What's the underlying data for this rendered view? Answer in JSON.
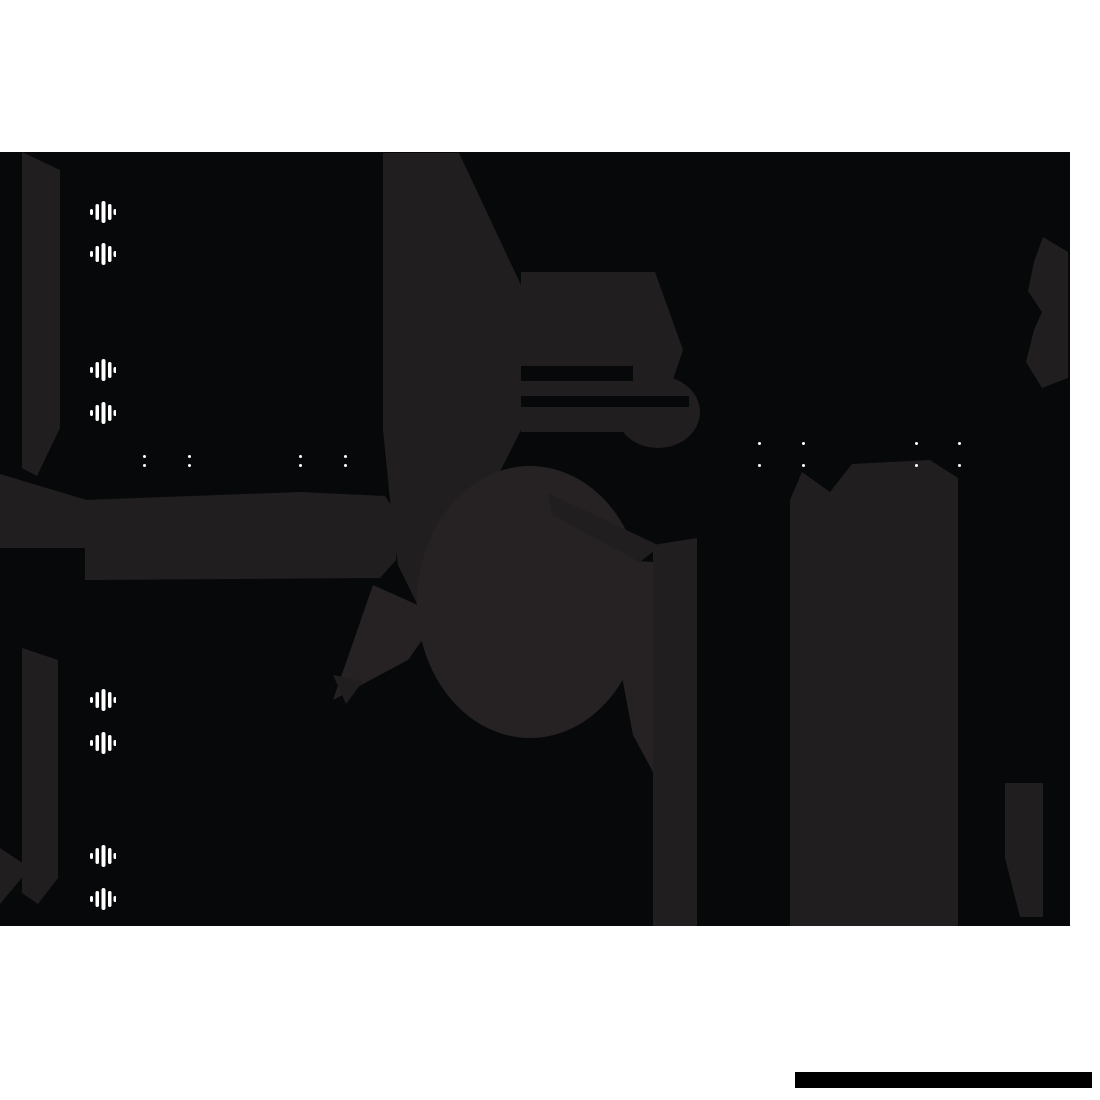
{
  "page": {
    "background": "#ffffff"
  },
  "stage": {
    "background": "#06080a",
    "shape_color": "#211e1f",
    "shape_color_light": "#262223"
  },
  "audio_icons": {
    "name": "audio-wave-icon",
    "color": "#ffffff",
    "x": 90,
    "positions_y": [
      200,
      242,
      358,
      401,
      688,
      731,
      844,
      887
    ]
  },
  "time_separators": {
    "char": ":",
    "color": "#ffffff",
    "groups": [
      {
        "label": "small",
        "dot_size": 3,
        "gap": 6,
        "y": 455,
        "xs": [
          143,
          188,
          299,
          344
        ]
      },
      {
        "label": "large",
        "dot_size": 3,
        "gap": 19,
        "y": 442,
        "xs": [
          758,
          802,
          915,
          958
        ]
      }
    ]
  },
  "footer_bar": {
    "color": "#000000",
    "x": 795,
    "y": 1072,
    "width": 297,
    "height": 16
  }
}
